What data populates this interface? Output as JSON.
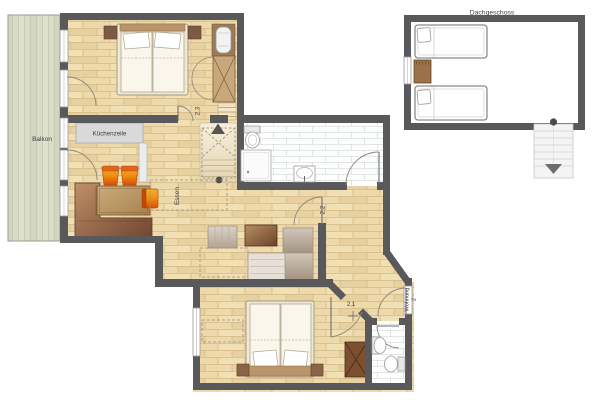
{
  "plan": {
    "attic": {
      "title": "Dachgeschoss"
    },
    "labels": {
      "balcony": "Balkon",
      "kitchenette": "Küchenzeile",
      "dining": "Essen",
      "room_23": "2,3",
      "room_22": "2,2",
      "room_21": "2,1",
      "entrance_line1": "Wohnung",
      "entrance_line2": "2"
    },
    "colors": {
      "wall": "#59585b",
      "wood_floor": "#eed9ab",
      "wood_line": "#d3ba88",
      "balcony_deck": "#dadcc8",
      "tile": "#fdfefe",
      "kitchen_unit": "#d9d9d9",
      "bench_brown": "#6f4430",
      "table_tan": "#c7a677",
      "stool_orange": "#e8650d",
      "sofa_taupe": "#c7b2aa",
      "wardrobe_tan": "#c9a87c",
      "furniture_brown": "#9a7149",
      "stair_grey": "#f4f4f4",
      "label_text": "#3e3e3e"
    }
  }
}
